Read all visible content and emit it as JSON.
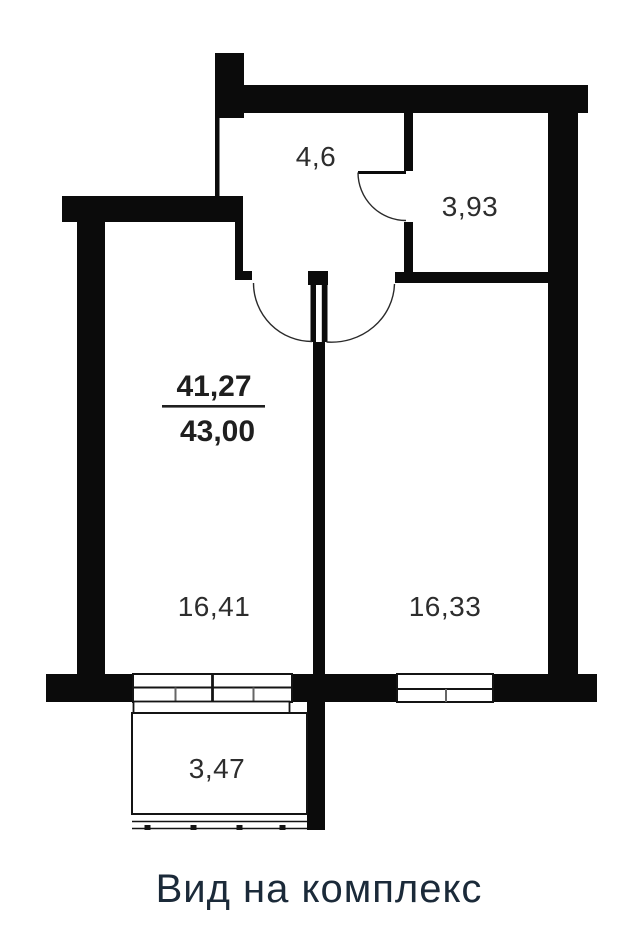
{
  "floorplan": {
    "caption": "Вид на комплекс",
    "rooms": {
      "hallway": {
        "area": "4,6"
      },
      "bathroom": {
        "area": "3,93"
      },
      "bedroom": {
        "area": "16,41"
      },
      "living_room": {
        "area": "16,33"
      },
      "balcony": {
        "area": "3,47"
      }
    },
    "area_summary": {
      "living": "41,27",
      "total": "43,00"
    },
    "colors": {
      "wall": "#0b0b0b",
      "line": "#141414",
      "room_label": "#2d2d2d",
      "area_number": "#1f1f1f",
      "caption": "#1b2a39"
    }
  }
}
